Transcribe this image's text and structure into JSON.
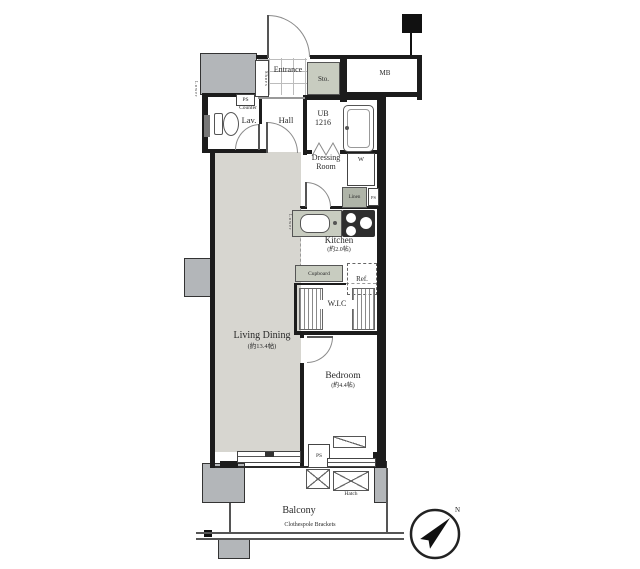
{
  "colors": {
    "wall": "#1c1c1c",
    "ld_floor": "#d7d6d0",
    "pillar": "#b3b6b9",
    "shaded_fixture": "#c8ccc0",
    "linen_fill": "#afb4a8"
  },
  "rooms": {
    "entrance": {
      "name": "Entrance"
    },
    "hall": {
      "name": "Hall"
    },
    "lavatory": {
      "name": "Lav.",
      "counter": "Counter"
    },
    "unit_bath": {
      "name": "UB",
      "size": "1216"
    },
    "dressing_room": {
      "line1": "Dressing",
      "line2": "Room"
    },
    "kitchen": {
      "name": "Kitchen",
      "size": "(約2.0帖)"
    },
    "living_dining": {
      "name": "Living Dining",
      "size": "(約13.4帖)"
    },
    "bedroom": {
      "name": "Bedroom",
      "size": "(約4.4帖)"
    },
    "wic": {
      "name": "W.I.C"
    },
    "balcony": {
      "name": "Balcony"
    }
  },
  "fixtures": {
    "shoes": "Shoes",
    "storage": "Sto.",
    "meter_box": "MB",
    "pipe_space": "PS",
    "washer": "W",
    "linen": "Linen",
    "cupboard": "Cupboard",
    "refrigerator": "Ref.",
    "hatch": "Hatch",
    "clothespole": "Clothespole Brackets",
    "lower_ceiling": "Lower",
    "north": "N"
  }
}
